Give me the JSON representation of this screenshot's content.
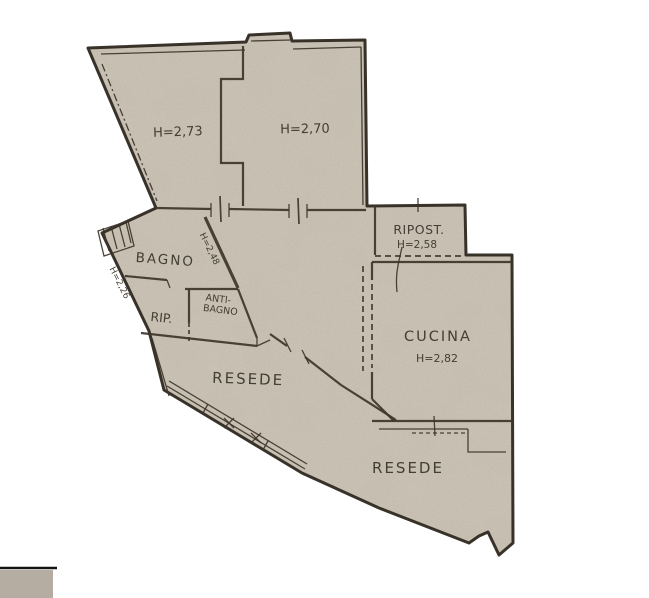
{
  "title": "Scanned apartment floor plan",
  "colors": {
    "paper": "#ffffff",
    "plan_fill": "#cdc5b7",
    "wall": "#3e352a",
    "text": "#332c22",
    "gray_block": "#b5ada2"
  },
  "rooms": {
    "room_top_left": {
      "height_label": "H=2,73"
    },
    "room_top_right": {
      "height_label": "H=2,70"
    },
    "ripost": {
      "name": "RIPOST.",
      "height_label": "H=2,58"
    },
    "bagno": {
      "name": "BAGNO",
      "height_label": "H=2,48"
    },
    "left_wall_note": {
      "height_label": "H=2,26"
    },
    "rip": {
      "name": "RIP."
    },
    "antibagno": {
      "name_line1": "ANTI-",
      "name_line2": "BAGNO"
    },
    "resede_central": {
      "name": "RESEDE"
    },
    "cucina": {
      "name": "CUCINA",
      "height_label": "H=2,82"
    },
    "resede_lower": {
      "name": "RESEDE"
    }
  }
}
